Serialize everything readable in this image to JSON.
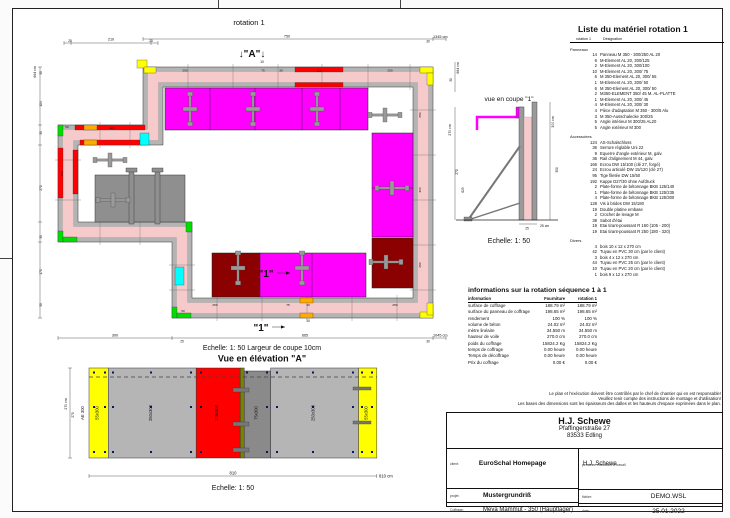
{
  "sheet": {
    "plan_title": "rotation 1"
  },
  "plan": {
    "marker_a": "↓\"A\"↓",
    "marker_a_sub": "10",
    "marker_1": "\"1\"",
    "marker_1_sub": "10",
    "dims": {
      "ta1": "25",
      "ta2": "210",
      "ta3": "25",
      "tb1": "750",
      "tb2": "30",
      "t_total": "1345 cm",
      "l1": "30",
      "l2": "104",
      "l3": "30",
      "l4": "270",
      "l5": "30",
      "l6": "170",
      "l7": "30",
      "l_total": "664 cm",
      "r1": "30",
      "r_total": "664 cm",
      "b1": "300",
      "b2": "25",
      "b3": "665",
      "b4": "30",
      "b_total": "1045 cm"
    },
    "labels": {
      "top": [
        "250",
        "75",
        "30",
        "125",
        "250"
      ],
      "bottom": [
        "250",
        "75",
        "30",
        "250"
      ],
      "right": [
        "250",
        "300",
        "250"
      ],
      "left": [
        "100",
        "125"
      ],
      "corner": "50"
    }
  },
  "elevation": {
    "scale_note": "Echelle: 1: 50   Largeur de coupe 10cm",
    "title": "Vue en élévation \"A\"",
    "scale": "Echelle: 1: 50",
    "side_label": "AE 300",
    "dim_left_total": "270 cm",
    "dim_left": "270",
    "dim_bottom": "810",
    "dim_bottom_total": "810 cm",
    "panels": [
      {
        "label": "55x300"
      },
      {
        "label": "250x300"
      },
      {
        "label": "125x300"
      },
      {
        "label": "75x300"
      },
      {
        "label": "250x300"
      },
      {
        "label": "55x300"
      }
    ]
  },
  "section": {
    "title": "vue en coupe \"1\"",
    "scale": "Echelle: 1: 50",
    "dim_left_total": "270 cm",
    "dim_left_a": "270",
    "dim_left_b": "629",
    "dim_right_total": "300 cm",
    "dim_right": "300",
    "dim_bottom": "25",
    "dim_bottom_unit": "25 cm"
  },
  "material_list": {
    "title": "Liste du matériel  rotation 1",
    "col_qty": "rotation 1",
    "col_name": "Désignation",
    "section_panneaux": "Panneaux",
    "section_accessoires": "Accessoires",
    "section_divers": "Divers",
    "panneaux": [
      {
        "q": "14",
        "n": "Panneau M 350 - 300/250 AL 20"
      },
      {
        "q": "6",
        "n": "M-Element AL 20, 300/125"
      },
      {
        "q": "2",
        "n": "M-Element AL 20, 300/100"
      },
      {
        "q": "10",
        "n": "M-Element AL 20, 300/ 75"
      },
      {
        "q": "6",
        "n": "M 350-Element AL 20, 300/ 55"
      },
      {
        "q": "1",
        "n": "M-Element AL 20, 300/ 50"
      },
      {
        "q": "6",
        "n": "M 350-Element AL 20, 300/ 50"
      },
      {
        "q": "2",
        "n": "M350-ELEMENT 350/ 45 M. AL-PLATTE"
      },
      {
        "q": "1",
        "n": "M-Element AL 20, 300/ 45"
      },
      {
        "q": "4",
        "n": "M-Element AL 20, 300/ 30"
      },
      {
        "q": "4",
        "n": "Pièce d'adaptation M 350 - 300/5 Alu"
      },
      {
        "q": "3",
        "n": "M 350-Ausschalecke 300/25"
      },
      {
        "q": "5",
        "n": "Angle intérieur M 300/25 AL20"
      },
      {
        "q": "5",
        "n": "Angle extérieur M 300"
      }
    ],
    "accessoires": [
      {
        "q": "124",
        "n": "AS-Schalschloss"
      },
      {
        "q": "36",
        "n": "Serrure réglable Uni 22"
      },
      {
        "q": "9",
        "n": "Equerre d'angle extérieur M, galv."
      },
      {
        "q": "36",
        "n": "Rail d'alignement M 44, galv."
      },
      {
        "q": "166",
        "n": "Ecrou DW 15/100 (clé 27, forgé)"
      },
      {
        "q": "24",
        "n": "Ecrou articulé DW 15/120 (clé 27)"
      },
      {
        "q": "95",
        "n": "Tige filetée DW 15/50"
      },
      {
        "q": "192",
        "n": "Kappe D27/30 ohne Aufdruck"
      },
      {
        "q": "2",
        "n": "Plate-forme de bétonnage BKB 125/140"
      },
      {
        "q": "1",
        "n": "Plate-forme de bétonnage BKB 125/235"
      },
      {
        "q": "4",
        "n": "Plate-forme de bétonnage BKB 125/300"
      },
      {
        "q": "128",
        "n": "Vis à brides DW 15/180"
      },
      {
        "q": "19",
        "n": "Double platine embase"
      },
      {
        "q": "2",
        "n": "Crochet de levage M"
      },
      {
        "q": "38",
        "n": "Sabot d'étai"
      },
      {
        "q": "19",
        "n": "Etai tirant-poussant R 160 (105 - 200)"
      },
      {
        "q": "19",
        "n": "Etai tirant-poussant R 250 (180 - 320)"
      }
    ],
    "divers": [
      {
        "q": "4",
        "n": "bois 10 x 12 x 270 cm"
      },
      {
        "q": "42",
        "n": "Tuyau en PVC 30 cm (par le client)"
      },
      {
        "q": "3",
        "n": "bois 4 x 12 x 270 cm"
      },
      {
        "q": "44",
        "n": "Tuyau en PVC 25 cm (par le client)"
      },
      {
        "q": "10",
        "n": "Tuyau en PVC 20 cm (par le client)"
      },
      {
        "q": "1",
        "n": "bois 9 x 12 x 270 cm"
      }
    ]
  },
  "info": {
    "title": "informations sur la rotation  séquence 1 à 1",
    "col_info": "information",
    "col_fourniture": "Fourniture",
    "col_rotation": "rotation 1",
    "rows": [
      {
        "n": "surface de coffrage",
        "a": "188.79 m²",
        "b": "188.79 m²"
      },
      {
        "n": "surface du panneau de coffrage",
        "a": "198.65 m²",
        "b": "198.65 m²"
      },
      {
        "n": "rendement",
        "a": "100 %",
        "b": "100 %"
      },
      {
        "n": "volume de béton",
        "a": "24.02 m³",
        "b": "24.02 m³"
      },
      {
        "n": "mètre linéaire",
        "a": "34.550 m",
        "b": "34.550 m"
      },
      {
        "n": "hauteur de voile",
        "a": "270.0 cm",
        "b": "270.0 cm"
      },
      {
        "n": "poids du coffrage",
        "a": "15824.2 Kg",
        "b": "15824.2 Kg"
      },
      {
        "n": "temps de coffrage",
        "a": "0.00 heure",
        "b": "0.00 heure"
      },
      {
        "n": "Temps de décoffrage",
        "a": "0.00 heure",
        "b": "0.00 heure"
      },
      {
        "n": "Prix du coffrage",
        "a": "0.00 €",
        "b": "0.00 €"
      }
    ]
  },
  "disclaimer": {
    "l1": "Le plan et l'exécution doivent être contrôlés par le chef de chantier qui en est responsable!",
    "l2": "Veuillez tenir compte des instructions de montage et d'utilisation!",
    "l3": "Les bases des dimensions sont les épaisseurs des dalles et les hauteurs d'espace exprimées dans le plan."
  },
  "title_block": {
    "company": "H.J. Schewe",
    "address1": "Pfaffingerstraße 27",
    "address2": "83533 Edling",
    "client_label": "client:",
    "client": "EuroSchal Homepage",
    "worker_label": "personne effectuant le travail",
    "worker": "H.J. Schewe",
    "project_label": "projet:",
    "project": "Mustergrundriß",
    "file_label": "fichier:",
    "file": "DEMO.WSL",
    "formwork_label": "Coffrage:",
    "formwork": "Meva Mammut - 350 (Hauptlager)",
    "date_label": "date:",
    "date": "25.01.2022"
  },
  "colors": {
    "magenta": "#ff00ff",
    "red": "#ff0000",
    "dark_red": "#8b0000",
    "yellow": "#ffff00",
    "green": "#00dd00",
    "cyan": "#00ffff",
    "orange": "#ffaa00",
    "wall_pink": "#f6caca",
    "panel_gray": "#b4b4b4",
    "dark_gray": "#8f8f8f",
    "tie_blue": "#001a66"
  }
}
